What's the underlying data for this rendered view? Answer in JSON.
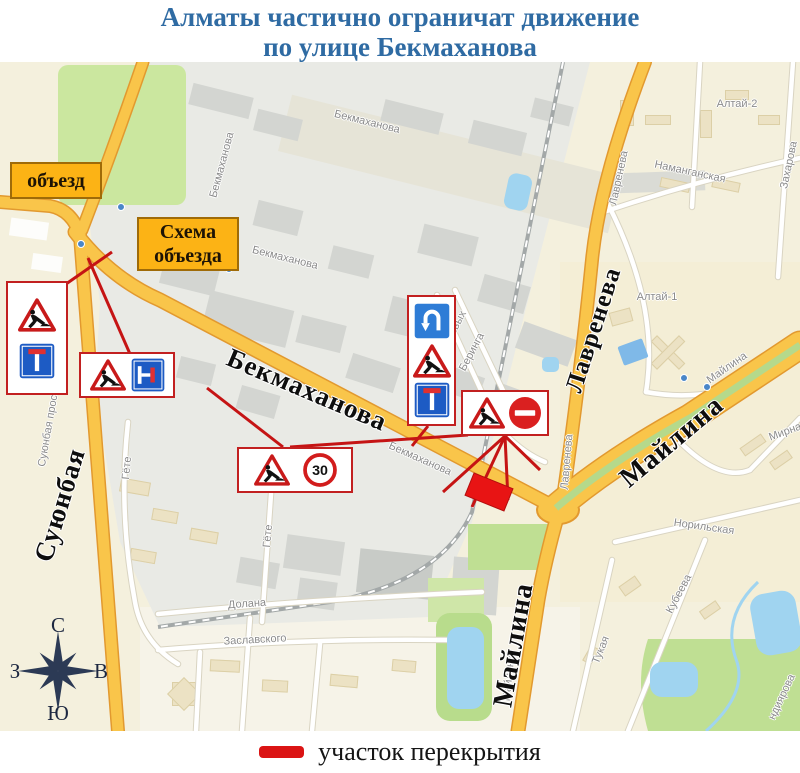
{
  "title": {
    "line1": "Алматы частично ограничат движение",
    "line2": "по улице Бекмаханова",
    "color": "#2f6ba3"
  },
  "legend": {
    "label": "участок перекрытия",
    "swatch_color": "#db1414"
  },
  "compass": {
    "n": "С",
    "s": "Ю",
    "w": "З",
    "e": "В"
  },
  "callouts": [
    {
      "id": "detour",
      "lines": [
        "объезд"
      ],
      "x": 10,
      "y": 100,
      "w": 92,
      "h": 37
    },
    {
      "id": "detour-scheme",
      "lines": [
        "Схема",
        "объезда"
      ],
      "x": 137,
      "y": 155,
      "w": 102,
      "h": 54
    }
  ],
  "closure": {
    "x": 489,
    "y": 430,
    "w": 42,
    "h": 24,
    "rotate": 22,
    "color": "#e81414"
  },
  "colors": {
    "road_fill": "#f9c54a",
    "road_casing": "#e2992f",
    "red_line": "#c51414",
    "callout_bg": "#fcb315",
    "water": "#a0d4f0",
    "green": "#cbe79f"
  },
  "major_labels": [
    {
      "text": "Бекмаханова",
      "x": 307,
      "y": 328,
      "r": 23,
      "size": 27
    },
    {
      "text": "Лавренева",
      "x": 594,
      "y": 268,
      "r": -72,
      "size": 25
    },
    {
      "text": "Майлина",
      "x": 672,
      "y": 380,
      "r": -40,
      "size": 28
    },
    {
      "text": "Майлина",
      "x": 514,
      "y": 583,
      "r": -80,
      "size": 28
    },
    {
      "text": "Суюнбая",
      "x": 60,
      "y": 443,
      "r": -73,
      "size": 27
    }
  ],
  "minor_labels": [
    {
      "text": "Бекмаханова",
      "x": 222,
      "y": 103,
      "r": -75
    },
    {
      "text": "Бекмаханова",
      "x": 367,
      "y": 60,
      "r": 14
    },
    {
      "text": "Бекмаханова",
      "x": 285,
      "y": 196,
      "r": 14
    },
    {
      "text": "Бекмаханова",
      "x": 420,
      "y": 397,
      "r": 24
    },
    {
      "text": "Суюнбая проспект",
      "x": 50,
      "y": 358,
      "r": -80
    },
    {
      "text": "Гёте",
      "x": 127,
      "y": 406,
      "r": -85
    },
    {
      "text": "Гёте",
      "x": 268,
      "y": 474,
      "r": -85
    },
    {
      "text": "Долана",
      "x": 247,
      "y": 542,
      "r": -4
    },
    {
      "text": "Заславского",
      "x": 255,
      "y": 578,
      "r": -3
    },
    {
      "text": "Резвых",
      "x": 455,
      "y": 266,
      "r": -62
    },
    {
      "text": "Беринга",
      "x": 472,
      "y": 290,
      "r": -62
    },
    {
      "text": "Лавренева",
      "x": 619,
      "y": 116,
      "r": -78
    },
    {
      "text": "Лавренева",
      "x": 567,
      "y": 400,
      "r": -85
    },
    {
      "text": "Наманганская",
      "x": 690,
      "y": 110,
      "r": 12
    },
    {
      "text": "Захарова",
      "x": 789,
      "y": 103,
      "r": -78
    },
    {
      "text": "Алтай-2",
      "x": 737,
      "y": 42,
      "r": 0
    },
    {
      "text": "Алтай-1",
      "x": 657,
      "y": 235,
      "r": 0
    },
    {
      "text": "Майлина",
      "x": 727,
      "y": 306,
      "r": -35
    },
    {
      "text": "Майлина",
      "x": 509,
      "y": 616,
      "r": -84
    },
    {
      "text": "Мирная",
      "x": 788,
      "y": 369,
      "r": -20
    },
    {
      "text": "Норильская",
      "x": 704,
      "y": 465,
      "r": 8
    },
    {
      "text": "Кубеева",
      "x": 679,
      "y": 532,
      "r": -62
    },
    {
      "text": "Тукая",
      "x": 601,
      "y": 588,
      "r": -68
    },
    {
      "text": "ндиярова",
      "x": 782,
      "y": 635,
      "r": -65
    }
  ],
  "sign_boxes": [
    {
      "id": "signs-suyunbay",
      "x": 6,
      "y": 219,
      "w": 62,
      "h": 114,
      "dir": "v",
      "items": [
        "roadworks-sign-icon",
        "dead-end-sign-icon"
      ]
    },
    {
      "id": "signs-west",
      "x": 79,
      "y": 290,
      "w": 96,
      "h": 46,
      "dir": "h",
      "items": [
        "roadworks-sign-icon",
        "dead-end-right-sign-icon"
      ]
    },
    {
      "id": "signs-speed-limit",
      "x": 237,
      "y": 385,
      "w": 116,
      "h": 46,
      "dir": "h",
      "items": [
        "roadworks-sign-icon",
        "speed-limit-30-sign-icon"
      ]
    },
    {
      "id": "signs-uturn",
      "x": 407,
      "y": 233,
      "w": 49,
      "h": 131,
      "dir": "v",
      "items": [
        "u-turn-sign-icon",
        "roadworks-sign-icon",
        "dead-end-sign-icon"
      ]
    },
    {
      "id": "signs-no-entry",
      "x": 461,
      "y": 328,
      "w": 88,
      "h": 46,
      "dir": "h",
      "items": [
        "roadworks-sign-icon",
        "no-entry-sign-icon"
      ]
    }
  ],
  "leader_lines": [
    {
      "x1": 66,
      "y1": 222,
      "x2": 112,
      "y2": 190
    },
    {
      "x1": 130,
      "y1": 292,
      "x2": 88,
      "y2": 196
    },
    {
      "x1": 283,
      "y1": 385,
      "x2": 207,
      "y2": 326
    },
    {
      "x1": 290,
      "y1": 385,
      "x2": 468,
      "y2": 373
    },
    {
      "x1": 428,
      "y1": 364,
      "x2": 412,
      "y2": 384
    },
    {
      "x1": 505,
      "y1": 374,
      "x2": 443,
      "y2": 430
    },
    {
      "x1": 505,
      "y1": 374,
      "x2": 472,
      "y2": 445
    },
    {
      "x1": 505,
      "y1": 374,
      "x2": 508,
      "y2": 438
    },
    {
      "x1": 505,
      "y1": 374,
      "x2": 540,
      "y2": 408
    }
  ]
}
